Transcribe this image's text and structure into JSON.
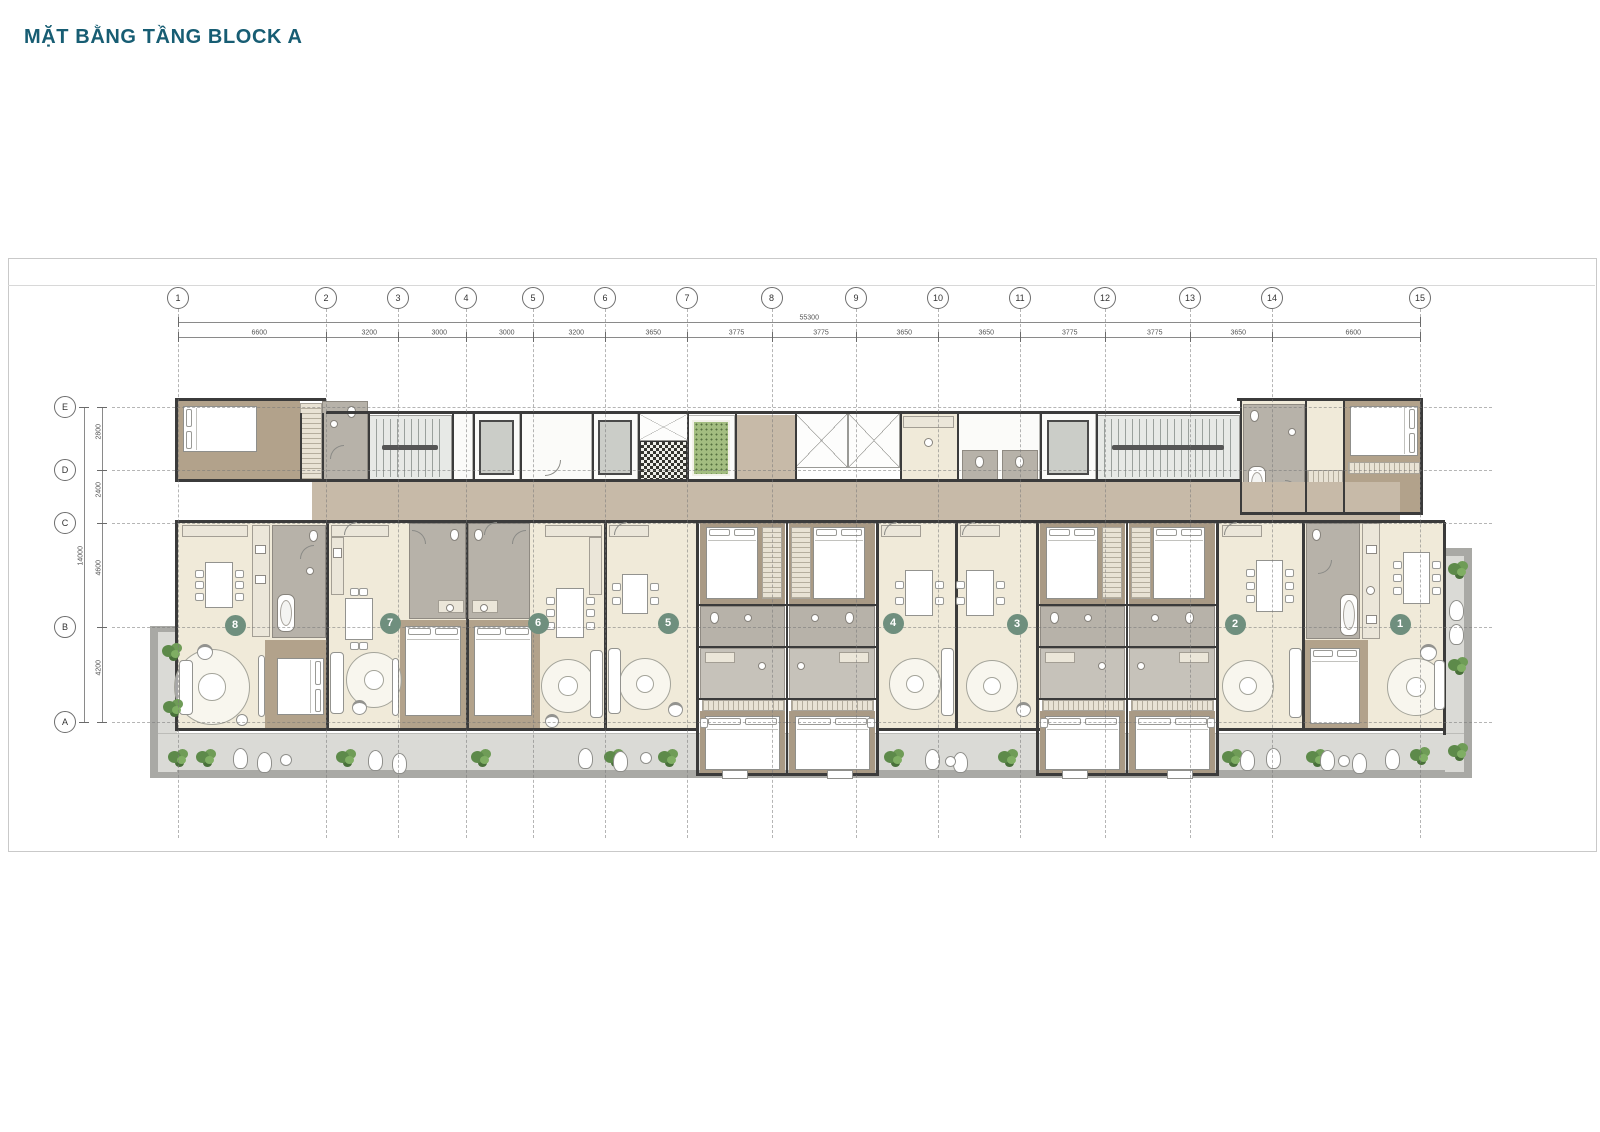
{
  "title": "MẶT BẰNG TẦNG BLOCK A",
  "grid": {
    "columns": {
      "labels": [
        "1",
        "2",
        "3",
        "4",
        "5",
        "6",
        "7",
        "8",
        "9",
        "10",
        "11",
        "12",
        "13",
        "14",
        "15"
      ],
      "spacings_mm": [
        "6600",
        "3200",
        "3000",
        "3000",
        "3200",
        "3650",
        "3775",
        "3775",
        "3650",
        "3650",
        "3775",
        "3775",
        "3650",
        "6600"
      ],
      "total_mm": "55300"
    },
    "rows": {
      "labels": [
        "E",
        "D",
        "C",
        "B",
        "A"
      ],
      "spacings_mm": [
        "2800",
        "2400",
        "4600",
        "4200"
      ],
      "total_mm": "14000"
    }
  },
  "units": {
    "labels": [
      "8",
      "7",
      "6",
      "5",
      "4",
      "3",
      "2",
      "1"
    ]
  },
  "colors": {
    "accent": "#175d73",
    "badge": "#6f8f7e",
    "corridor_tan": "#c7baa8",
    "floor_cream": "#f0ead9",
    "bedroom_tan": "#b2a28b",
    "bedroom_tan_dark": "#a99a85",
    "balcony_gray": "#dadad6",
    "mat_green": "#a3bd80",
    "plant_green": "#5d8a4a"
  }
}
